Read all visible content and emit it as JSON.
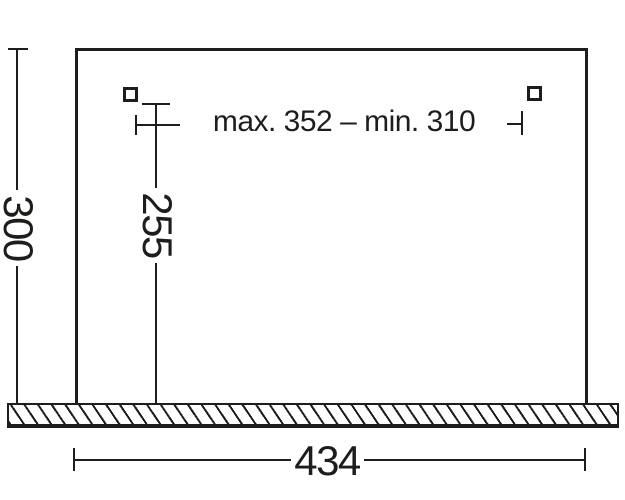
{
  "colors": {
    "line": "#1d1d1b",
    "background": "#ffffff"
  },
  "diagram": {
    "left_height_label": "300",
    "hole_height_label": "255",
    "hole_spacing_label": "max. 352 – min. 310",
    "bottom_width_label": "434"
  }
}
